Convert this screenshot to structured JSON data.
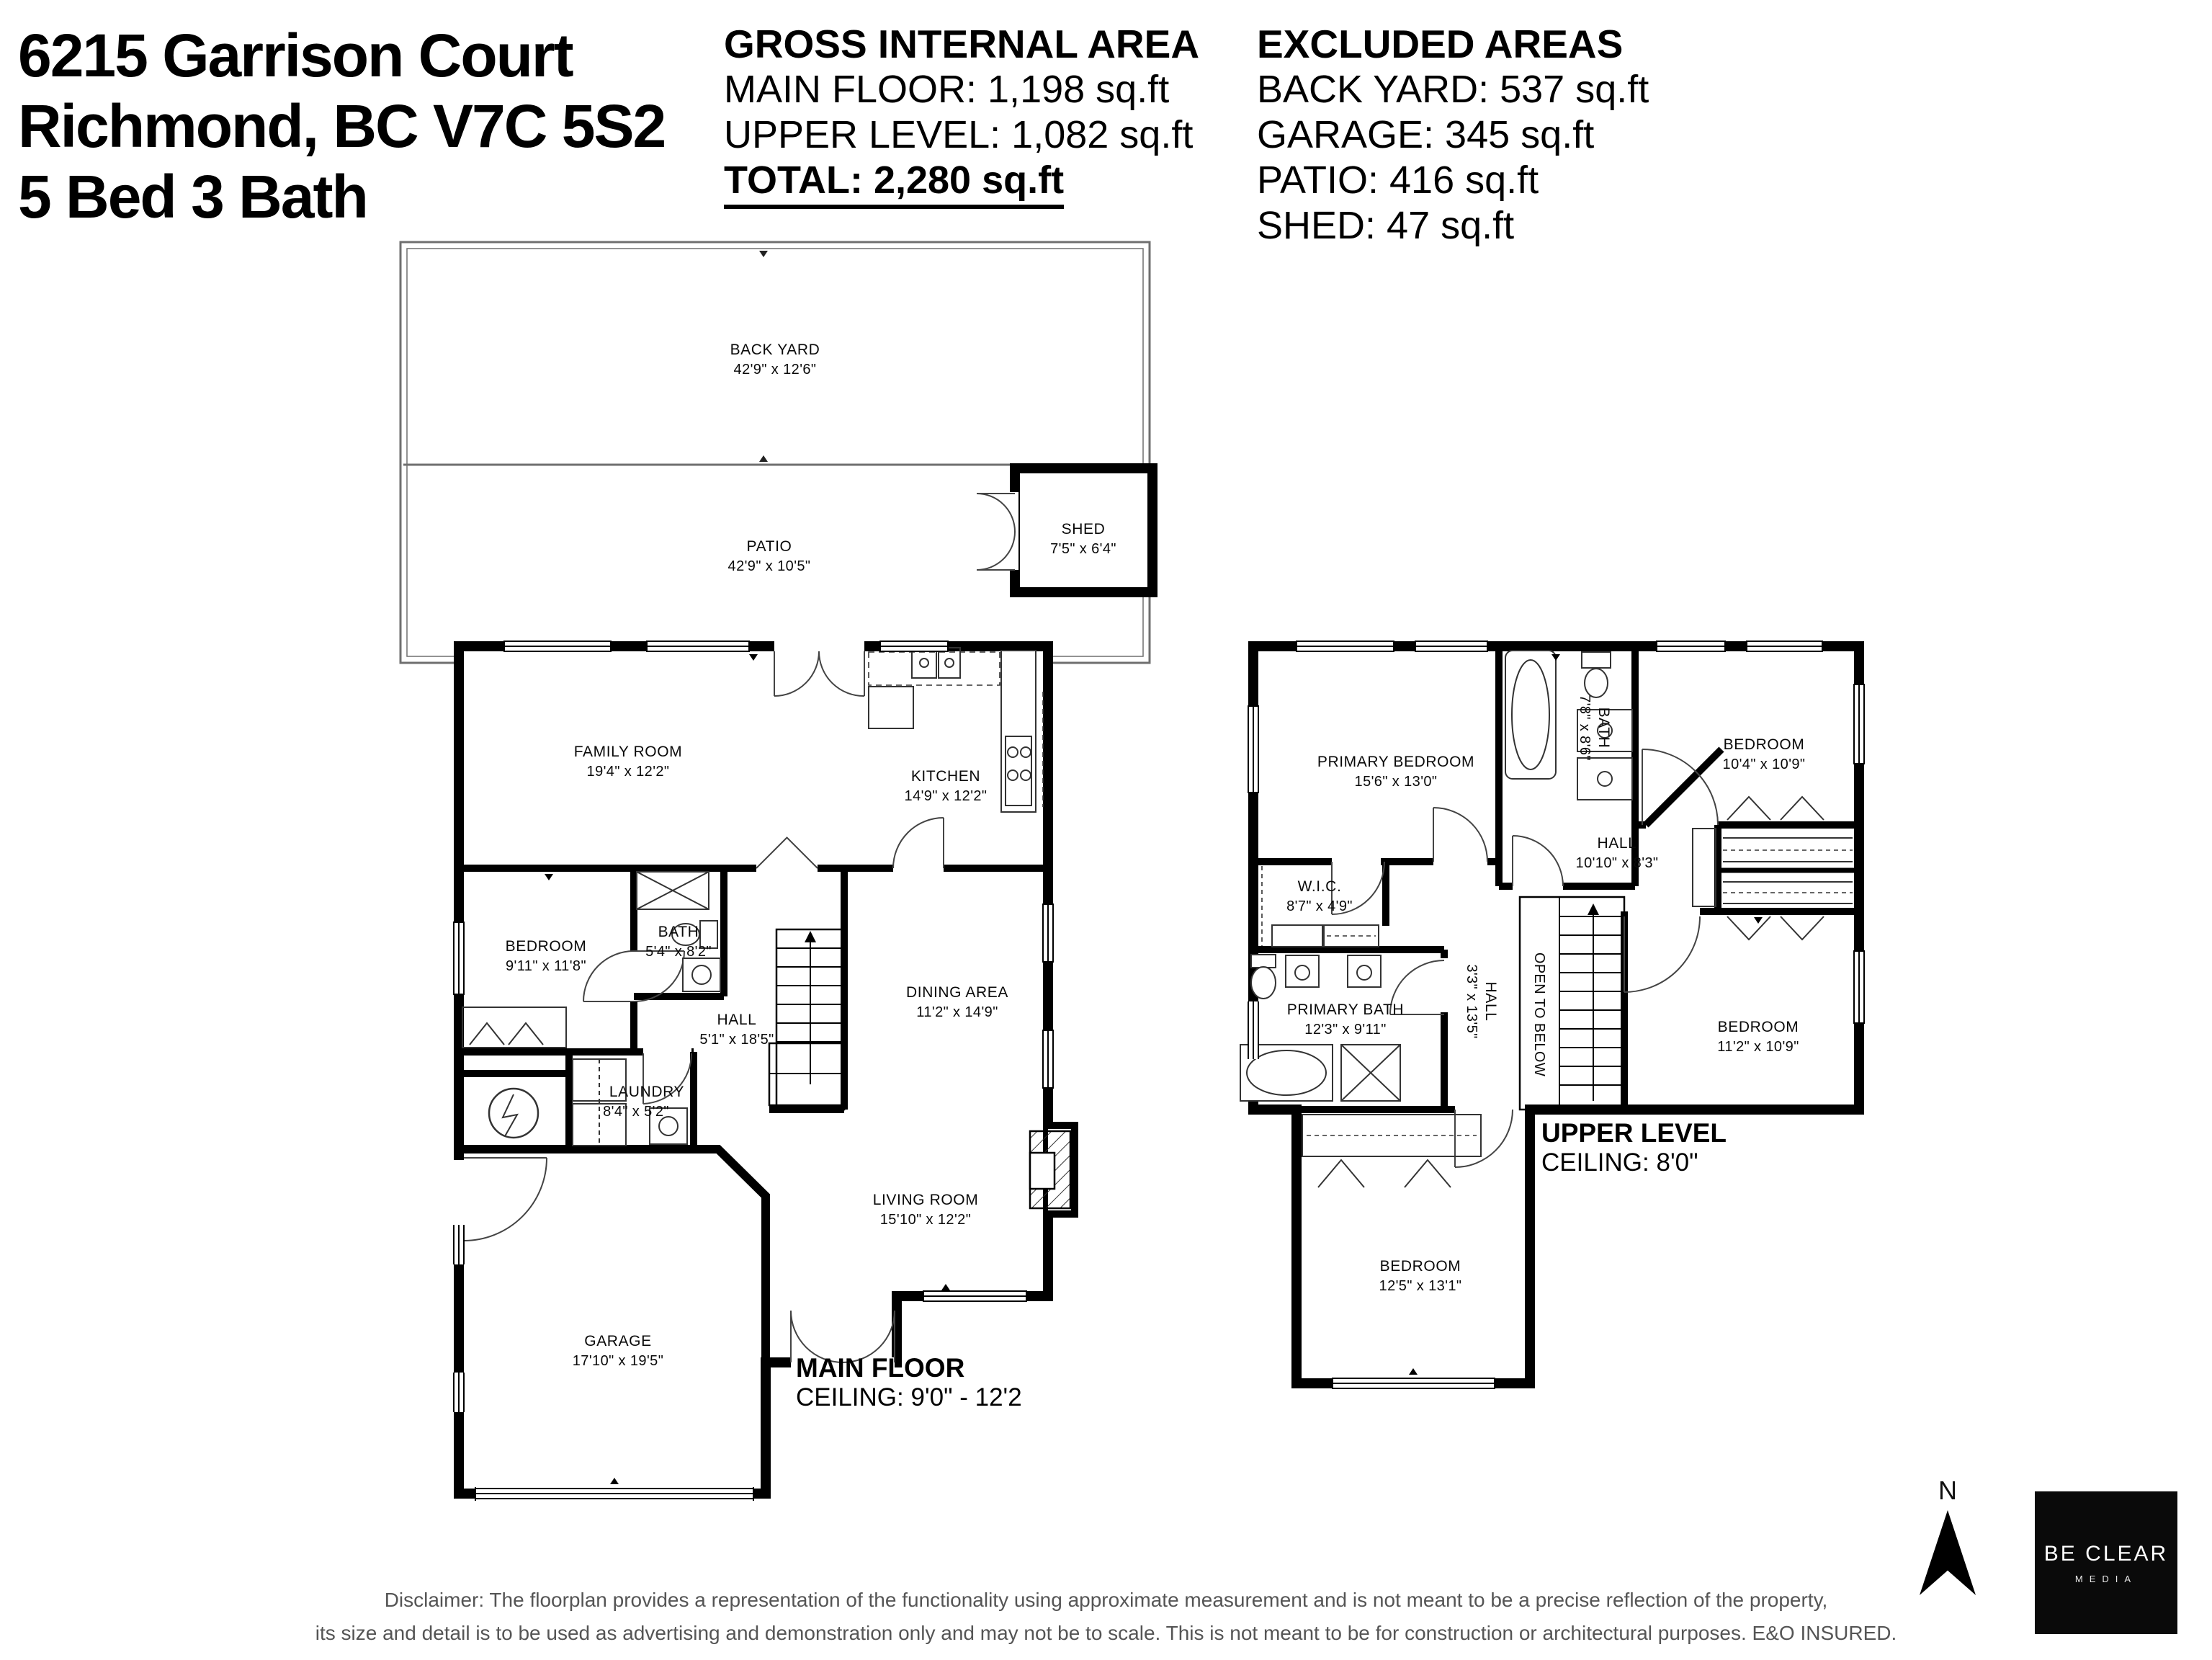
{
  "header": {
    "line1": "6215 Garrison Court",
    "line2": "Richmond, BC V7C 5S2",
    "line3": "5 Bed 3 Bath"
  },
  "gia": {
    "title": "GROSS INTERNAL AREA",
    "rows": [
      "MAIN FLOOR: 1,198 sq.ft",
      "UPPER LEVEL: 1,082 sq.ft"
    ],
    "total": "TOTAL: 2,280 sq.ft"
  },
  "exa": {
    "title": "EXCLUDED AREAS",
    "rows": [
      "BACK YARD: 537 sq.ft",
      "GARAGE: 345 sq.ft",
      "PATIO: 416 sq.ft",
      "SHED: 47 sq.ft"
    ]
  },
  "outdoor": {
    "back_yard": {
      "name": "BACK YARD",
      "dims": "42'9\" x 12'6\""
    },
    "patio": {
      "name": "PATIO",
      "dims": "42'9\" x 10'5\""
    },
    "shed": {
      "name": "SHED",
      "dims": "7'5\" x 6'4\""
    }
  },
  "main_floor": {
    "title": "MAIN FLOOR",
    "ceiling": "CEILING: 9'0\" - 12'2",
    "rooms": {
      "family_room": {
        "name": "FAMILY ROOM",
        "dims": "19'4\" x 12'2\""
      },
      "kitchen": {
        "name": "KITCHEN",
        "dims": "14'9\" x 12'2\""
      },
      "bedroom": {
        "name": "BEDROOM",
        "dims": "9'11\" x 11'8\""
      },
      "bath": {
        "name": "BATH",
        "dims": "5'4\" x 8'2\""
      },
      "hall": {
        "name": "HALL",
        "dims": "5'1\" x 18'5\""
      },
      "dining": {
        "name": "DINING AREA",
        "dims": "11'2\" x 14'9\""
      },
      "laundry": {
        "name": "LAUNDRY",
        "dims": "8'4\" x 5'2\""
      },
      "living": {
        "name": "LIVING ROOM",
        "dims": "15'10\" x 12'2\""
      },
      "garage": {
        "name": "GARAGE",
        "dims": "17'10\" x 19'5\""
      }
    }
  },
  "upper_level": {
    "title": "UPPER LEVEL",
    "ceiling": "CEILING: 8'0\"",
    "rooms": {
      "primary_bedroom": {
        "name": "PRIMARY BEDROOM",
        "dims": "15'6\" x 13'0\""
      },
      "bath": {
        "name": "BATH",
        "dims": "7'8\" x 8'6\""
      },
      "bedroom_top": {
        "name": "BEDROOM",
        "dims": "10'4\" x 10'9\""
      },
      "hall": {
        "name": "HALL",
        "dims": "10'10\" x 8'3\""
      },
      "wic": {
        "name": "W.I.C.",
        "dims": "8'7\" x 4'9\""
      },
      "primary_bath": {
        "name": "PRIMARY BATH",
        "dims": "12'3\" x 9'11\""
      },
      "hall2": {
        "name": "HALL",
        "dims": "3'3\" x 13'5\""
      },
      "open_below": {
        "label": "OPEN TO BELOW"
      },
      "bedroom_right": {
        "name": "BEDROOM",
        "dims": "11'2\" x 10'9\""
      },
      "bedroom_bottom": {
        "name": "BEDROOM",
        "dims": "12'5\" x 13'1\""
      }
    }
  },
  "footer": {
    "disclaimer_line1": "Disclaimer: The floorplan provides a representation of the functionality using approximate measurement and is not meant to be a precise reflection of the property,",
    "disclaimer_line2": "its size and detail is to be used as advertising and demonstration only and may not be to scale. This is not meant to be for construction or architectural purposes. E&O INSURED.",
    "compass_label": "N",
    "logo_line1": "BE CLEAR",
    "logo_line2": "MEDIA"
  }
}
